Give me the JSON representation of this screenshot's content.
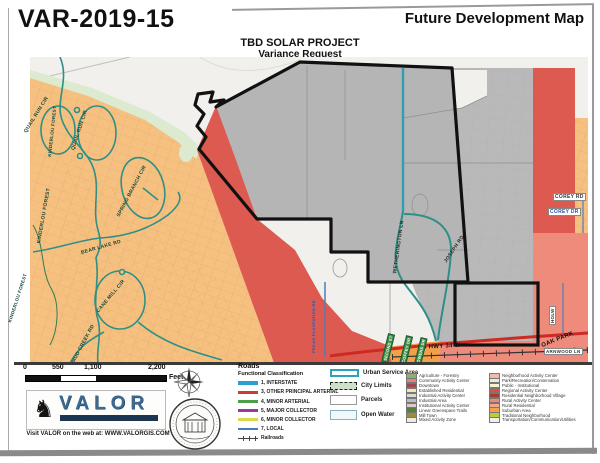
{
  "header": {
    "case_number": "VAR-2019-15",
    "map_title": "Future Development Map",
    "project_name": "TBD SOLAR PROJECT",
    "project_subtitle": "Variance Request"
  },
  "map": {
    "streets": [
      {
        "name": "QUAIL RUN CIR"
      },
      {
        "name": "KINDERLOU FOREST"
      },
      {
        "name": "QUAIL RUN CIR"
      },
      {
        "name": "SPRING BRANCH CIR"
      },
      {
        "name": "KINDERLOU FOREST"
      },
      {
        "name": "BEAR LAKE RD"
      },
      {
        "name": "CANE MILL CIR"
      },
      {
        "name": "MUD CREEK RD"
      },
      {
        "name": "KINDERLOU FOREST"
      },
      {
        "name": "WETHERINGTON LN"
      },
      {
        "name": "JOSEPH RD"
      },
      {
        "name": "PECAN PLANTATION RD"
      },
      {
        "name": "US HWY 34 W"
      },
      {
        "name": "COREY DR"
      },
      {
        "name": "COREY RD"
      },
      {
        "name": "OAK PARK"
      },
      {
        "name": "ARNWOOD LN"
      },
      {
        "name": "HOLW"
      },
      {
        "name": "SECOND ST"
      },
      {
        "name": "COFFEY DR"
      },
      {
        "name": "OWENS DR"
      }
    ],
    "region_colors": {
      "background": "#f1f0ec",
      "suburban_orange": "#f6c180",
      "greenspace_strip": "#dcead0",
      "industrial_gray": "#b9b9b9",
      "regional_red": "#dd5a50",
      "rural_salmon": "#ee8b7b",
      "bottom_orange": "#f2a049",
      "subject_outline": "#111111",
      "subdivision_road_teal": "#2e8f87",
      "urban_service_teal": "#2f9fae",
      "highway_red": "#cc2a24",
      "local_road_blue": "#4d7fb5"
    }
  },
  "scale_bar": {
    "ticks": [
      "0",
      "550",
      "1,100",
      "2,200"
    ],
    "unit": "Feet"
  },
  "valor": {
    "name": "VALOR",
    "web_line": "Visit VALOR on the web at: WWW.VALORGIS.COM"
  },
  "legend": {
    "roads": {
      "title": "Roads",
      "subtitle": "Functional Classification",
      "items": [
        {
          "label": "1, INTERSTATE",
          "color": "#2b9fd0"
        },
        {
          "label": "3, OTHER PRINCIPAL ARTERIAL",
          "color": "#cf3a3a"
        },
        {
          "label": "4, MINOR ARTERIAL",
          "color": "#4e9e4a"
        },
        {
          "label": "5, MAJOR COLLECTOR",
          "color": "#993a99"
        },
        {
          "label": "6, MINOR COLLECTOR",
          "color": "#d9d949"
        },
        {
          "label": "7, LOCAL",
          "color": "#3f7fbf"
        }
      ],
      "railroads_label": "Railroads"
    },
    "areas": [
      {
        "label": "Urban Service Area"
      },
      {
        "label": "City Limits"
      },
      {
        "label": "Parcels"
      },
      {
        "label": "Open Water"
      }
    ],
    "land_use": [
      {
        "label": "Agriculture - Forestry",
        "color": "#94ac72"
      },
      {
        "label": "Community Activity Center",
        "color": "#e4837a"
      },
      {
        "label": "Downtown",
        "color": "#a04454"
      },
      {
        "label": "Established Residential",
        "color": "#f2e9a8"
      },
      {
        "label": "Industrial Activity Center",
        "color": "#d9d9d9"
      },
      {
        "label": "Industrial Area",
        "color": "#bdbdbd"
      },
      {
        "label": "Institutional Activity Center",
        "color": "#e0c9c9"
      },
      {
        "label": "Linear Greenspace Trails",
        "color": "#55803c"
      },
      {
        "label": "Mill Town",
        "color": "#9b8d33"
      },
      {
        "label": "Mixed Activity Zone",
        "color": "#ebebe6"
      },
      {
        "label": "Neighborhood Activity Center",
        "color": "#f2b9b4"
      },
      {
        "label": "Park/Recreation/Conservation",
        "color": "#e6efd4"
      },
      {
        "label": "Public - Institutional",
        "color": "#f9f3cd"
      },
      {
        "label": "Regional Activity Center",
        "color": "#d94f43"
      },
      {
        "label": "Residential Neighborhood Village",
        "color": "#a83c2e"
      },
      {
        "label": "Rural Activity Center",
        "color": "#ed8a76"
      },
      {
        "label": "Rural Residential",
        "color": "#f1a58e"
      },
      {
        "label": "Suburban Area",
        "color": "#f0a449"
      },
      {
        "label": "Traditional Neighborhood",
        "color": "#c2c93e"
      },
      {
        "label": "Transportation/Communication/Utilities",
        "color": "#f0efe9"
      }
    ]
  }
}
